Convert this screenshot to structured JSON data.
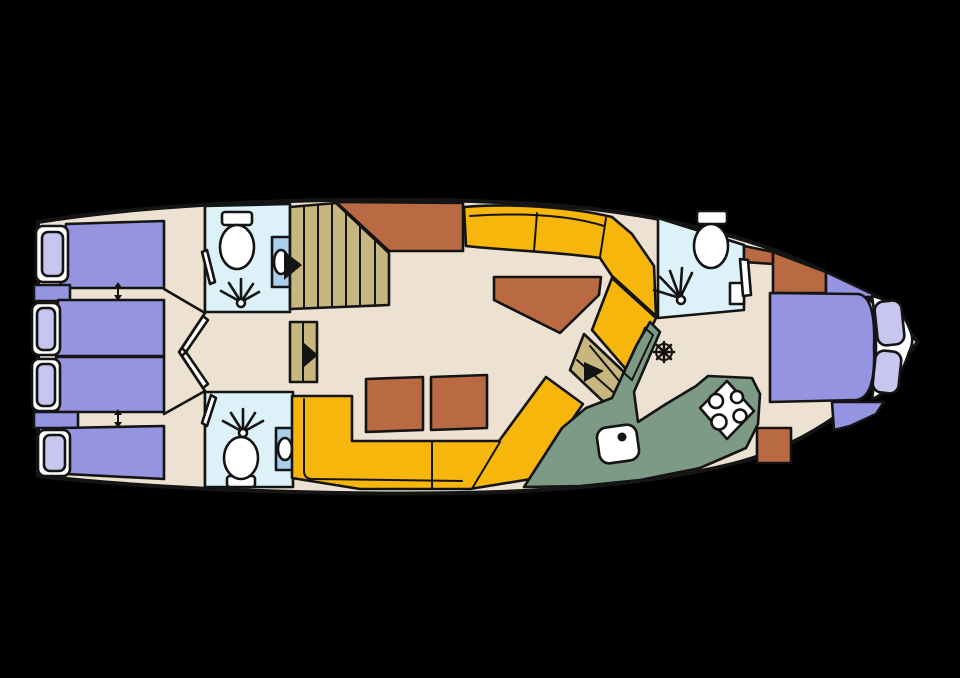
{
  "figure": {
    "type": "boat-floor-plan",
    "orientation": "bow-right-stern-left"
  },
  "colors": {
    "background": "#000000",
    "outline": "#141414",
    "floor": "#EDE2D2",
    "bed": "#9494E0",
    "pillow": "#C6C6F0",
    "bathroom": "#DCF2F8",
    "sink_cabinet": "#A9CFEC",
    "fixture_white": "#FFFFFF",
    "stairs": "#C7B67D",
    "sofa": "#F7B60B",
    "table": "#B96A43",
    "galley": "#7C9A84",
    "counter_edge": "#A3C4B8"
  },
  "icons": {
    "toilet": "toilet-icon",
    "shower": "shower-spray-icon",
    "sink": "sink-basin-icon",
    "stove": "stove-burners-icon",
    "galley_sink": "galley-sink-icon",
    "helm": "helm-wheel-icon",
    "stair_arrow": "stairs-direction-arrow-icon",
    "bed_arrow": "bed-slide-arrow-icon",
    "door": "door-leaf-icon"
  }
}
